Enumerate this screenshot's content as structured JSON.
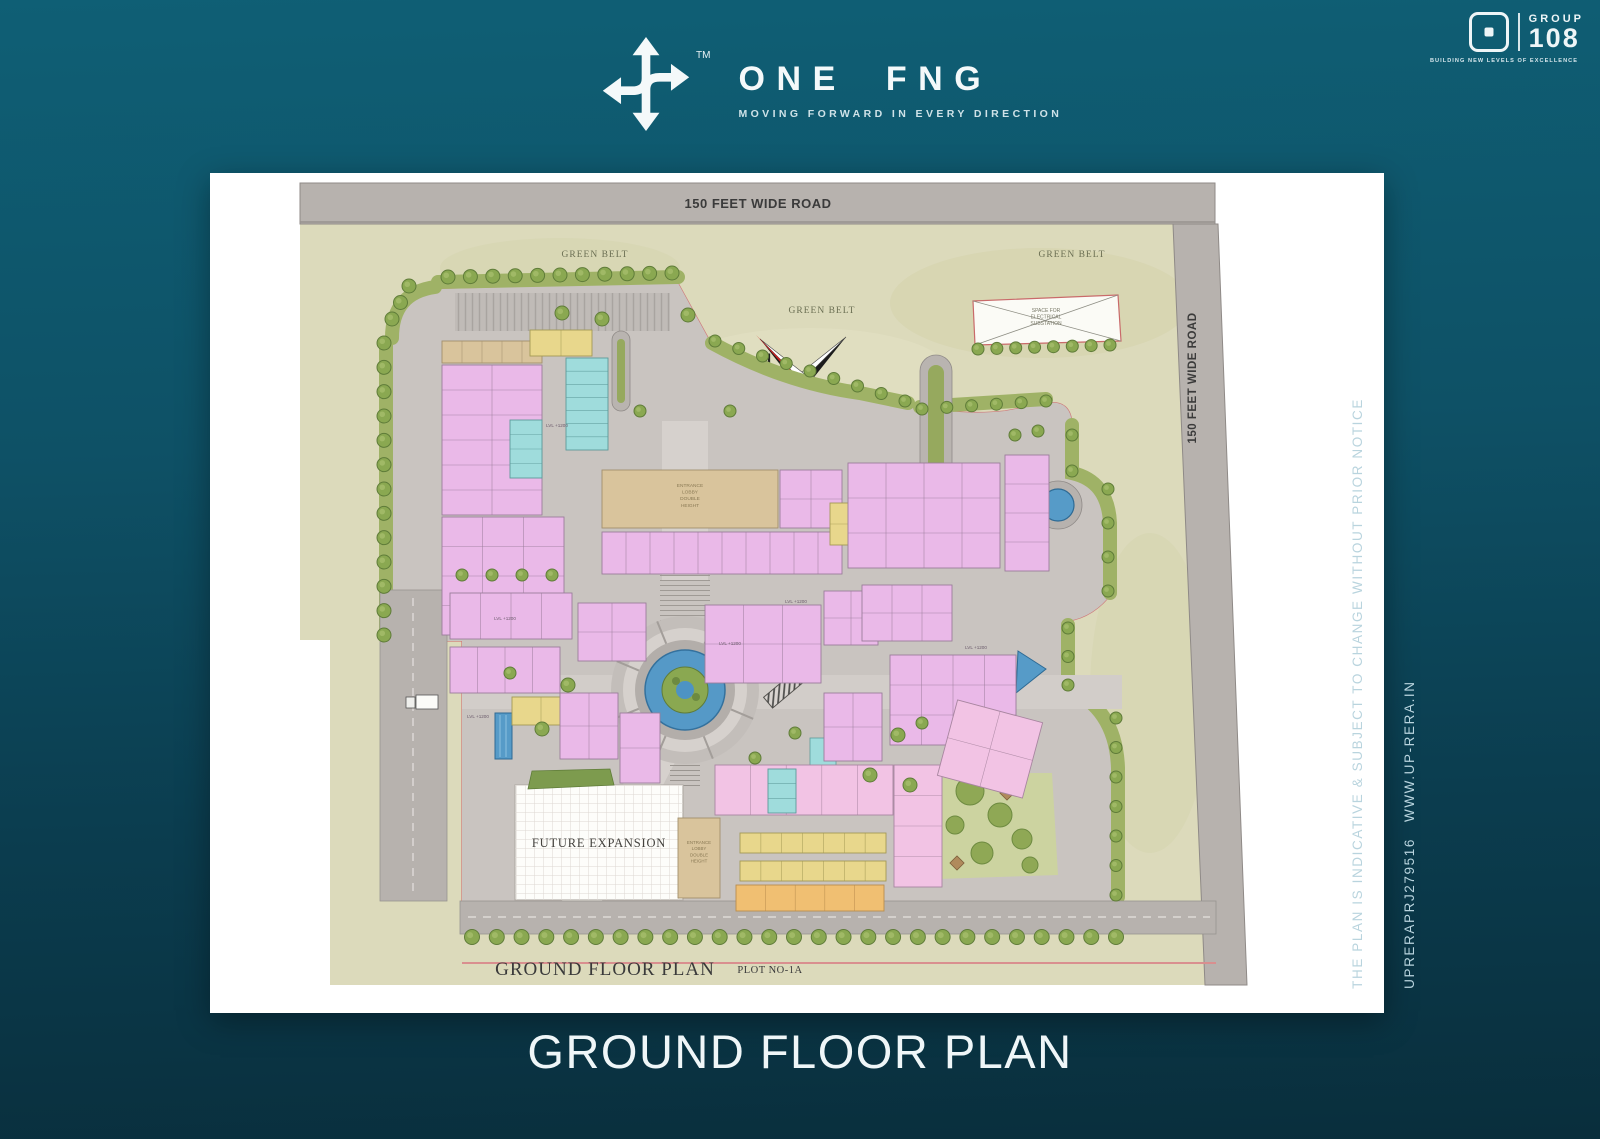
{
  "header": {
    "brand": {
      "name": "ONE FNG",
      "tm": "TM",
      "tagline": "MOVING FORWARD IN EVERY DIRECTION"
    },
    "group108": {
      "group": "GROUP",
      "number": "108",
      "tagline": "BUILDING NEW LEVELS OF EXCELLENCE"
    }
  },
  "footer": {
    "title": "GROUND FLOOR PLAN"
  },
  "note": {
    "line1": "THE PLAN IS INDICATIVE & SUBJECT TO CHANGE WITHOUT PRIOR NOTICE",
    "line2": "UPRERAPRJ279516   WWW.UP-RERA.IN"
  },
  "plan": {
    "roads": {
      "top_label": "150 FEET WIDE ROAD",
      "right_label": "150 FEET WIDE ROAD"
    },
    "labels": {
      "green_belt": "GREEN BELT",
      "compass_n": "N",
      "future_expansion": "FUTURE EXPANSION",
      "floor_plan": "GROUND FLOOR PLAN",
      "plot_no": "PLOT NO-1A"
    },
    "multiline": [
      {
        "name": "substation-label",
        "lines": [
          "SPACE FOR",
          "ELECTRICAL",
          "SUBSTATION"
        ],
        "x": 836,
        "y": 139,
        "dy": 6.5,
        "size": 5,
        "fill": "#777766"
      },
      {
        "name": "entrance-lobby-label",
        "lines": [
          "ENTRANCE",
          "LOBBY",
          "DOUBLE",
          "HEIGHT"
        ],
        "x": 480,
        "y": 314,
        "dy": 6.6,
        "size": 4.8,
        "fill": "#8a7a55"
      },
      {
        "name": "entrance-lobby2-label",
        "lines": [
          "ENTRANCE",
          "LOBBY",
          "DOUBLE",
          "HEIGHT"
        ],
        "x": 489,
        "y": 671,
        "dy": 6.2,
        "size": 4.4,
        "fill": "#8a7a55"
      }
    ],
    "lvl": {
      "text": "LVL +1200",
      "pos": [
        [
          347,
          254
        ],
        [
          295,
          447
        ],
        [
          520,
          472
        ],
        [
          766,
          476
        ],
        [
          268,
          545
        ],
        [
          586,
          430
        ]
      ]
    },
    "colors": {
      "road": "#b7b2ae",
      "beige": "#dcdabb",
      "paving": "#c9c4c0",
      "path": "#d6d1cd",
      "green_band": "#9fb266",
      "tree": "#8aa851",
      "tree_stroke": "#5f7c39",
      "water": "#569bc8",
      "boundary_red": "#cf7a7a",
      "fills": {
        "pink": {
          "f": "#eab9e8",
          "s": "#9b7d9b"
        },
        "pinkL": {
          "f": "#f2c3e4",
          "s": "#a886a0"
        },
        "tan": {
          "f": "#d9c49c",
          "s": "#a2906d"
        },
        "yellow": {
          "f": "#e8d78c",
          "s": "#a39a55"
        },
        "orange": {
          "f": "#f0bf72",
          "s": "#b98d4e"
        },
        "cyan": {
          "f": "#9fdcdc",
          "s": "#5c9a9a"
        }
      }
    },
    "clusters": [
      {
        "x": 232,
        "y": 168,
        "w": 100,
        "h": 22,
        "c": 5,
        "r": 1,
        "f": "tan"
      },
      {
        "x": 232,
        "y": 192,
        "w": 100,
        "h": 150,
        "c": 2,
        "r": 6,
        "f": "pink"
      },
      {
        "x": 232,
        "y": 344,
        "w": 122,
        "h": 118,
        "c": 3,
        "r": 4,
        "f": "pink"
      },
      {
        "x": 320,
        "y": 157,
        "w": 62,
        "h": 26,
        "c": 2,
        "r": 1,
        "f": "yellow"
      },
      {
        "x": 356,
        "y": 185,
        "w": 42,
        "h": 92,
        "c": 1,
        "r": 7,
        "f": "cyan"
      },
      {
        "x": 300,
        "y": 247,
        "w": 32,
        "h": 58,
        "c": 1,
        "r": 4,
        "f": "cyan"
      },
      {
        "x": 240,
        "y": 420,
        "w": 122,
        "h": 46,
        "c": 4,
        "r": 1,
        "f": "pink"
      },
      {
        "x": 240,
        "y": 474,
        "w": 110,
        "h": 46,
        "c": 4,
        "r": 1,
        "f": "pink"
      },
      {
        "x": 302,
        "y": 524,
        "w": 58,
        "h": 28,
        "c": 2,
        "r": 1,
        "f": "yellow"
      },
      {
        "x": 392,
        "y": 297,
        "w": 176,
        "h": 58,
        "c": 1,
        "r": 1,
        "f": "tan"
      },
      {
        "x": 392,
        "y": 359,
        "w": 240,
        "h": 42,
        "c": 10,
        "r": 1,
        "f": "pink"
      },
      {
        "x": 570,
        "y": 297,
        "w": 62,
        "h": 58,
        "c": 2,
        "r": 2,
        "f": "pink"
      },
      {
        "x": 620,
        "y": 330,
        "w": 24,
        "h": 42,
        "c": 1,
        "r": 2,
        "f": "yellow"
      },
      {
        "x": 638,
        "y": 290,
        "w": 152,
        "h": 105,
        "c": 4,
        "r": 3,
        "f": "pink"
      },
      {
        "x": 795,
        "y": 282,
        "w": 44,
        "h": 116,
        "c": 1,
        "r": 4,
        "f": "pink"
      },
      {
        "x": 368,
        "y": 430,
        "w": 68,
        "h": 58,
        "c": 2,
        "r": 2,
        "f": "pink"
      },
      {
        "x": 350,
        "y": 520,
        "w": 58,
        "h": 66,
        "c": 2,
        "r": 2,
        "f": "pink"
      },
      {
        "x": 410,
        "y": 540,
        "w": 40,
        "h": 70,
        "c": 1,
        "r": 2,
        "f": "pink"
      },
      {
        "x": 495,
        "y": 432,
        "w": 116,
        "h": 78,
        "c": 3,
        "r": 2,
        "f": "pink"
      },
      {
        "x": 614,
        "y": 418,
        "w": 54,
        "h": 54,
        "c": 2,
        "r": 2,
        "f": "pink"
      },
      {
        "x": 652,
        "y": 412,
        "w": 90,
        "h": 56,
        "c": 3,
        "r": 2,
        "f": "pink"
      },
      {
        "x": 680,
        "y": 482,
        "w": 126,
        "h": 90,
        "c": 4,
        "r": 3,
        "f": "pink"
      },
      {
        "x": 614,
        "y": 520,
        "w": 58,
        "h": 68,
        "c": 2,
        "r": 2,
        "f": "pink"
      },
      {
        "x": 505,
        "y": 592,
        "w": 178,
        "h": 50,
        "c": 5,
        "r": 1,
        "f": "pinkL"
      },
      {
        "x": 558,
        "y": 596,
        "w": 28,
        "h": 44,
        "c": 1,
        "r": 3,
        "f": "cyan"
      },
      {
        "x": 530,
        "y": 660,
        "w": 146,
        "h": 20,
        "c": 7,
        "r": 1,
        "f": "yellow"
      },
      {
        "x": 530,
        "y": 688,
        "w": 146,
        "h": 20,
        "c": 7,
        "r": 1,
        "f": "yellow"
      },
      {
        "x": 526,
        "y": 712,
        "w": 148,
        "h": 26,
        "c": 5,
        "r": 1,
        "f": "orange"
      },
      {
        "x": 684,
        "y": 592,
        "w": 48,
        "h": 122,
        "c": 1,
        "r": 4,
        "f": "pinkL"
      },
      {
        "x": 468,
        "y": 645,
        "w": 42,
        "h": 80,
        "c": 1,
        "r": 1,
        "f": "tan"
      },
      {
        "x": 736,
        "y": 537,
        "w": 88,
        "h": 78,
        "c": 2,
        "r": 2,
        "f": "pinkL",
        "rot": 15
      }
    ],
    "tree_rows": [
      [
        238,
        104,
        462,
        100,
        11,
        7
      ],
      [
        199,
        113,
        182,
        146,
        3,
        7
      ],
      [
        174,
        170,
        174,
        462,
        13,
        7
      ],
      [
        505,
        168,
        695,
        228,
        9,
        6
      ],
      [
        712,
        236,
        836,
        228,
        6,
        6
      ],
      [
        862,
        262,
        862,
        298,
        2,
        6
      ],
      [
        898,
        316,
        898,
        418,
        4,
        6
      ],
      [
        858,
        455,
        858,
        512,
        3,
        6
      ],
      [
        906,
        545,
        906,
        722,
        7,
        6
      ],
      [
        262,
        764,
        906,
        764,
        27,
        7.5
      ],
      [
        768,
        176,
        900,
        172,
        8,
        6
      ],
      [
        252,
        402,
        342,
        402,
        4,
        6
      ]
    ],
    "tree_singles": [
      [
        352,
        140,
        7
      ],
      [
        392,
        146,
        7
      ],
      [
        478,
        142,
        7
      ],
      [
        430,
        238,
        6
      ],
      [
        520,
        238,
        6
      ],
      [
        358,
        512,
        7
      ],
      [
        332,
        556,
        7
      ],
      [
        300,
        500,
        6
      ],
      [
        688,
        562,
        7
      ],
      [
        712,
        550,
        6
      ],
      [
        660,
        602,
        7
      ],
      [
        700,
        612,
        7
      ],
      [
        805,
        262,
        6
      ],
      [
        828,
        258,
        6
      ],
      [
        585,
        560,
        6
      ],
      [
        545,
        585,
        6
      ]
    ],
    "garden_mounds": [
      [
        760,
        618,
        14
      ],
      [
        790,
        642,
        12
      ],
      [
        812,
        666,
        10
      ],
      [
        745,
        652,
        9
      ],
      [
        772,
        680,
        11
      ],
      [
        820,
        692,
        8
      ]
    ],
    "garden_squares": [
      [
        797,
        620
      ],
      [
        747,
        690
      ]
    ]
  }
}
